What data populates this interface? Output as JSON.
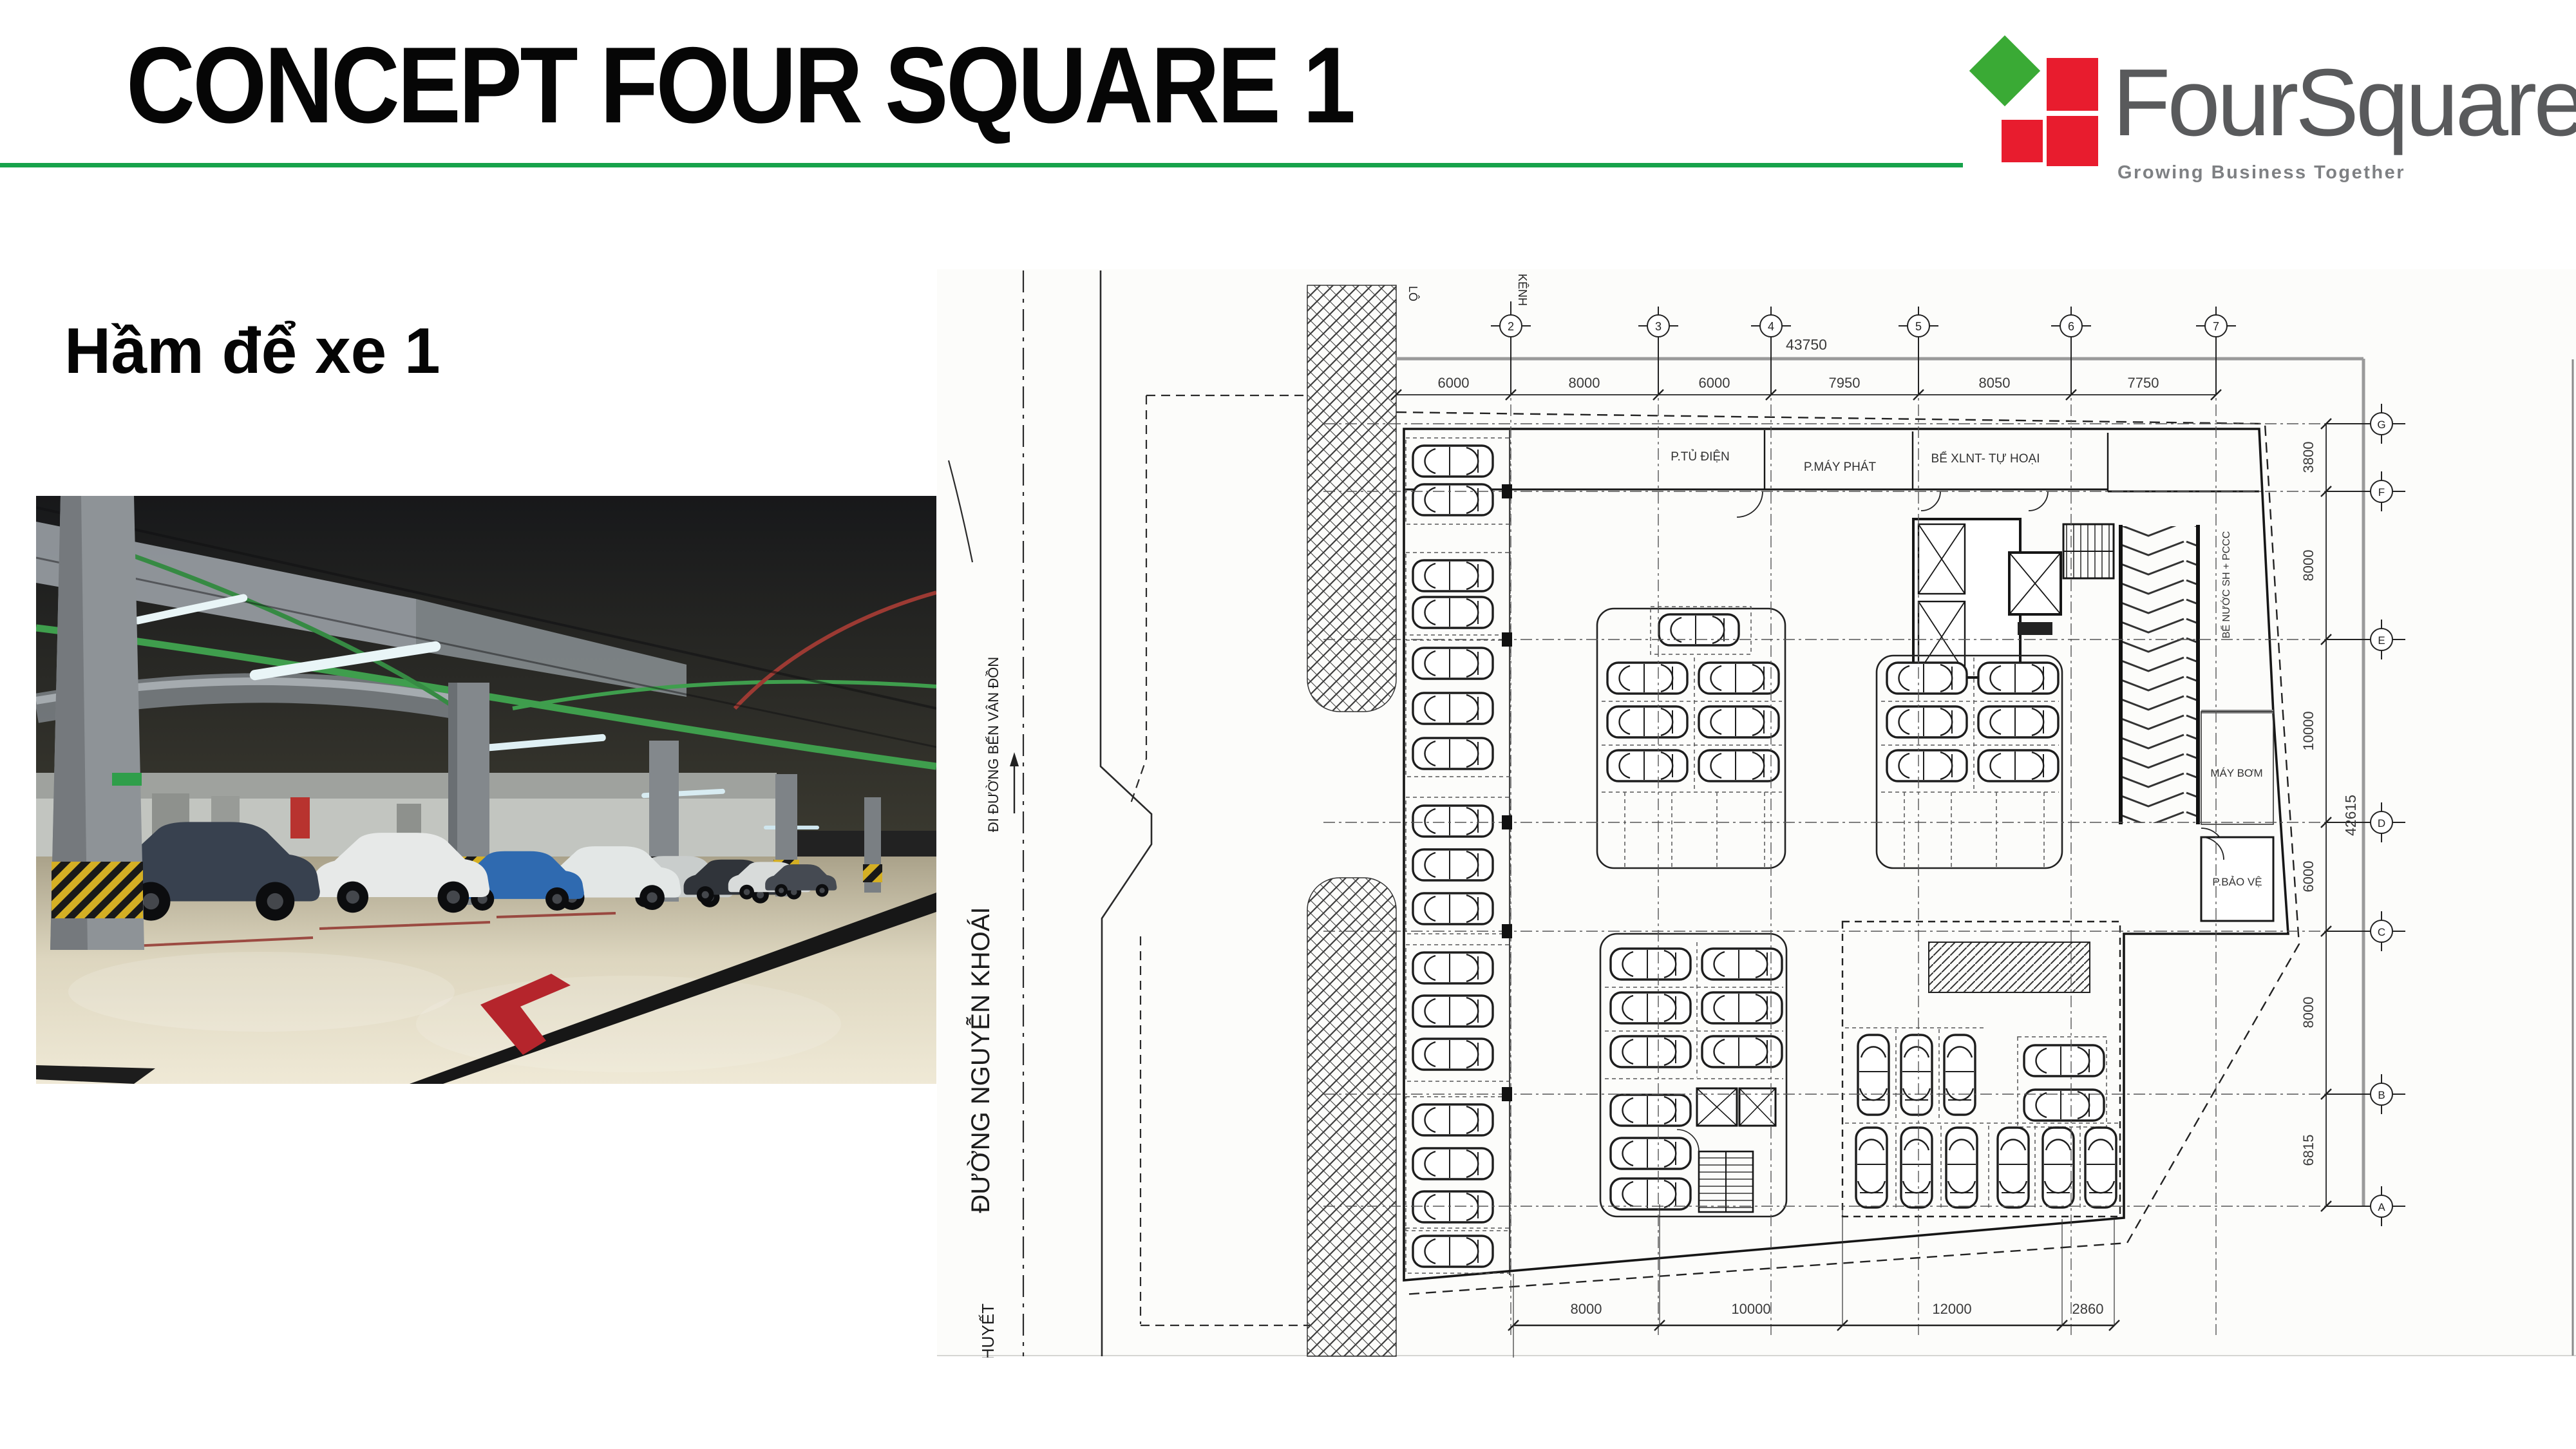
{
  "slide": {
    "title": "CONCEPT FOUR SQUARE 1",
    "subtitle": "Hầm để xe 1",
    "accent_green": "#17a24b"
  },
  "logo": {
    "word": "FourSquare",
    "tagline": "Growing Business Together",
    "green": "#3aaa35",
    "red": "#e81c2e",
    "text_color": "#595a5c"
  },
  "photo": {
    "subject": "underground parking garage with parked cars, green pipes, beige epoxy floor, red arrow floor marking"
  },
  "plan": {
    "col_axes": [
      "2",
      "3",
      "4",
      "5",
      "6",
      "7"
    ],
    "col_dims": [
      "6000",
      "8000",
      "6000",
      "7950",
      "8050",
      "7750"
    ],
    "col_total": "43750",
    "row_axes": [
      "G",
      "F",
      "E",
      "D",
      "C",
      "B",
      "A"
    ],
    "row_dims": [
      "3800",
      "8000",
      "10000",
      "6000",
      "8000",
      "6815"
    ],
    "row_total": "42615",
    "bottom_dims": [
      "8000",
      "10000",
      "12000",
      "2860"
    ],
    "rooms": {
      "electrical": "P.TỦ ĐIỆN",
      "generator": "P.MÁY PHÁT",
      "septic": "BỂ XLNT- TỰ HOẠI",
      "water_tank": "BỂ NƯỚC SH + PCCC",
      "pump": "MÁY BƠM",
      "security": "P.BẢO VỆ"
    },
    "streets": {
      "main": "ĐƯỜNG NGUYỄN KHOÁI",
      "direction": "ĐI ĐƯỜNG BẾN VÂN ĐỒN",
      "partial": "HUYẾT",
      "lot_left": "LÔ",
      "lot_top": "KÊNH"
    }
  }
}
